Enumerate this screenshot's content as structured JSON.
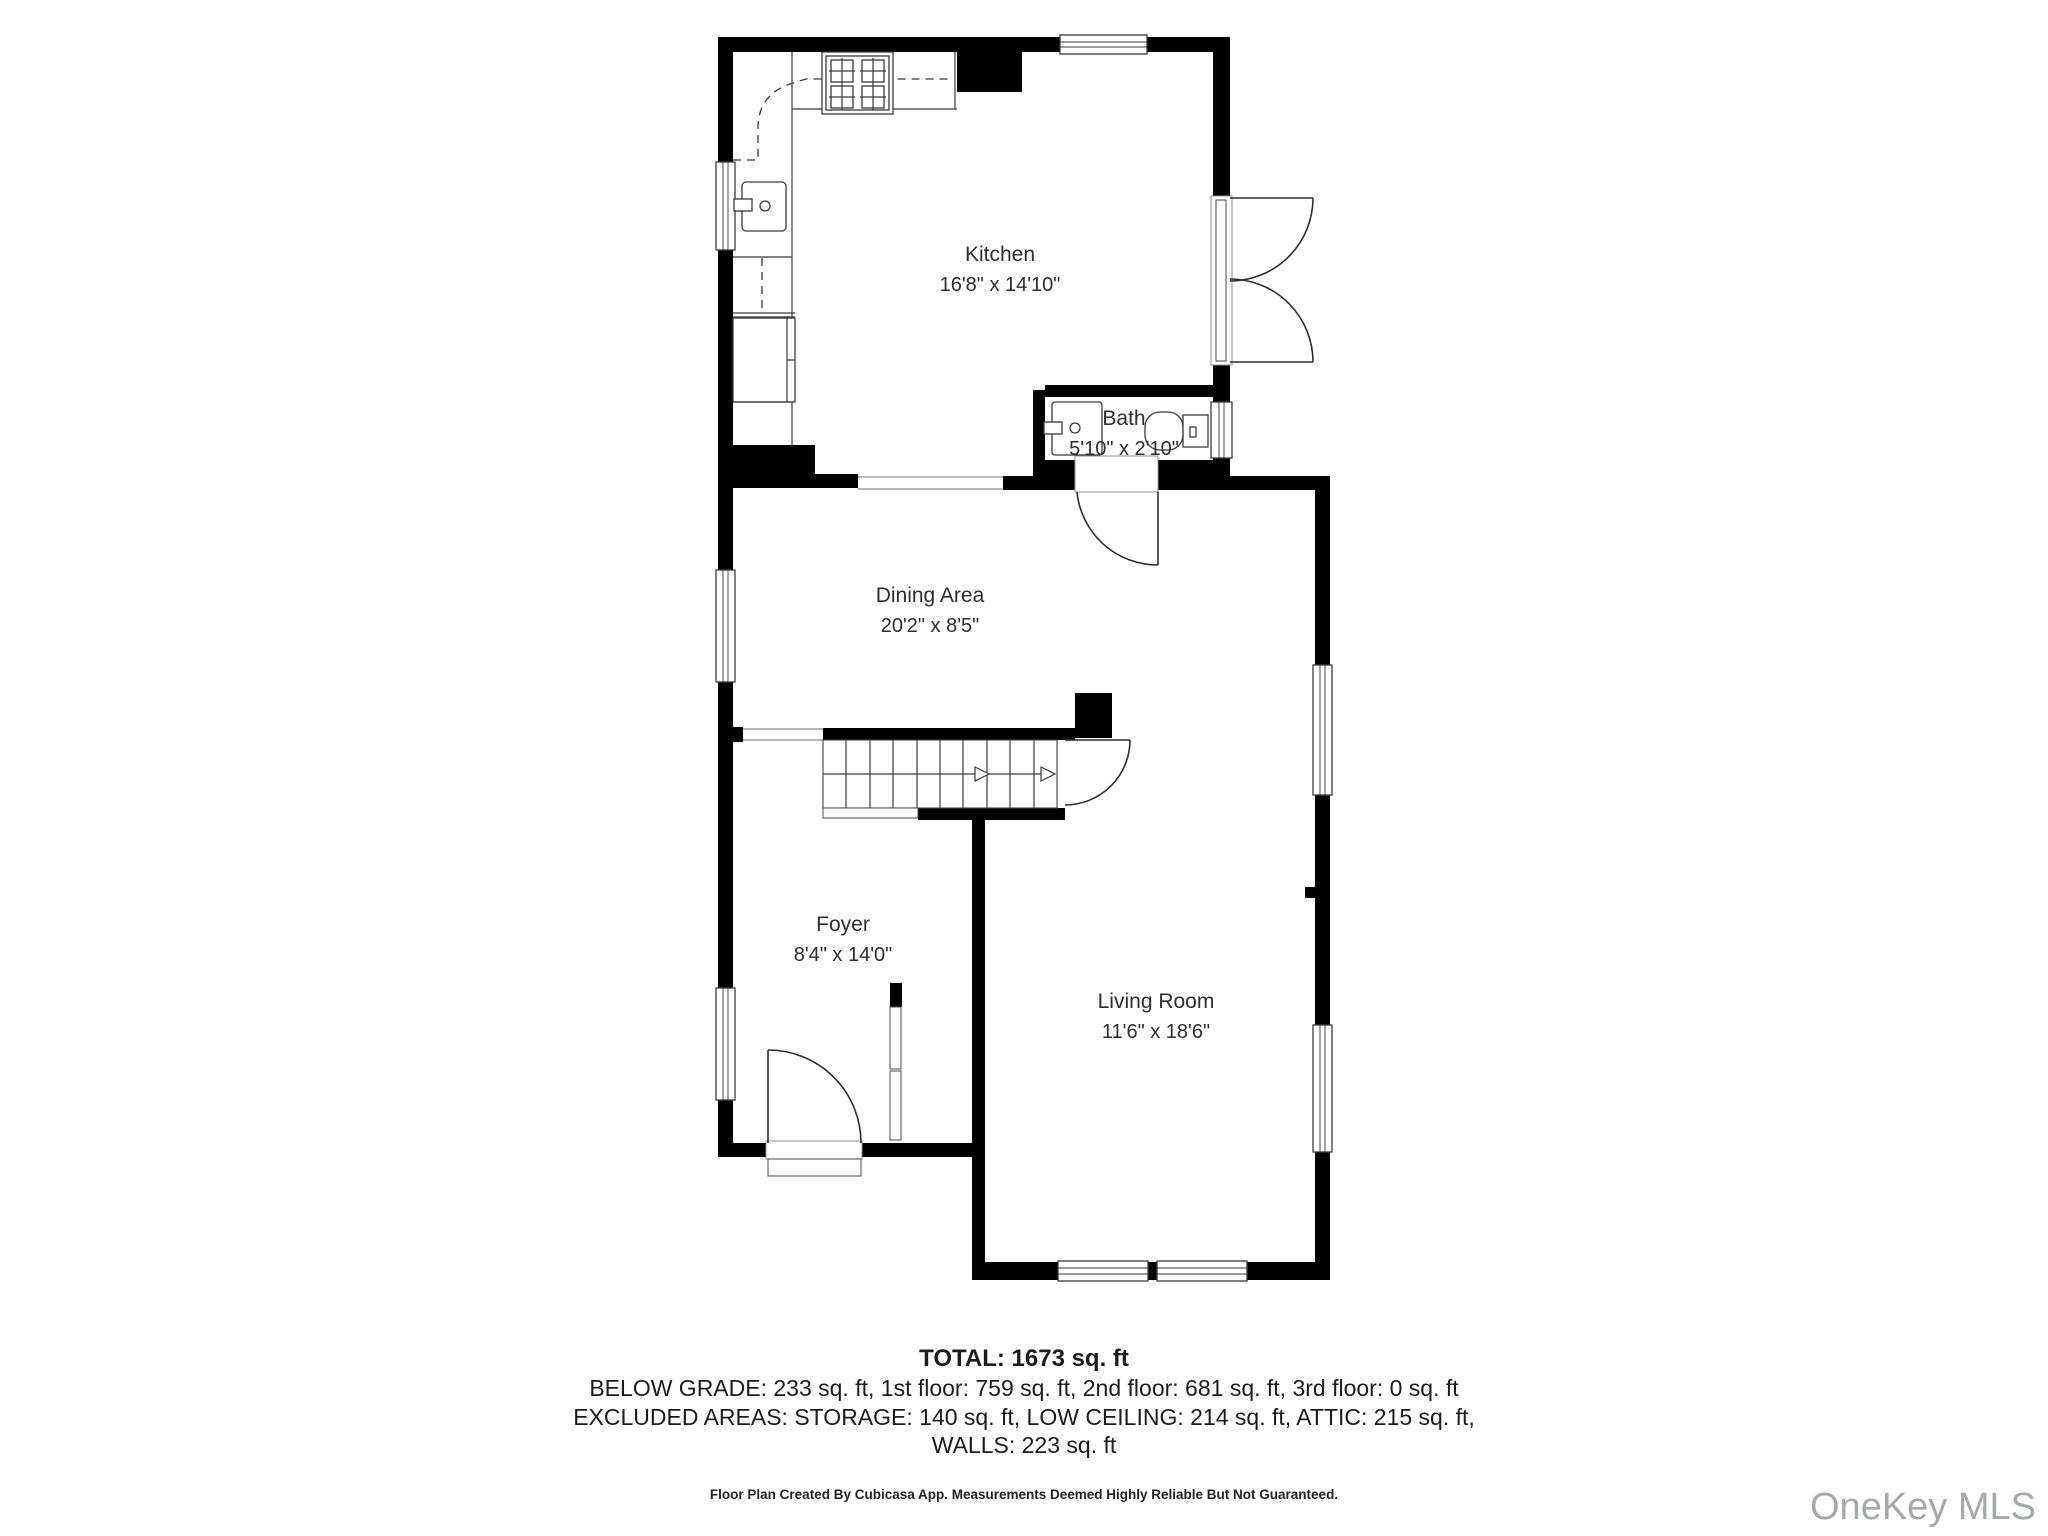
{
  "rooms": {
    "kitchen": {
      "name": "Kitchen",
      "dims": "16'8\" x 14'10\""
    },
    "bath": {
      "name": "Bath",
      "dims": "5'10\" x 2'10\""
    },
    "dining": {
      "name": "Dining Area",
      "dims": "20'2\" x 8'5\""
    },
    "foyer": {
      "name": "Foyer",
      "dims": "8'4\" x 14'0\""
    },
    "living": {
      "name": "Living Room",
      "dims": "11'6\" x 18'6\""
    }
  },
  "summary": {
    "total": "TOTAL: 1673 sq. ft",
    "below_grade_line": "BELOW GRADE: 233 sq. ft, 1st floor: 759 sq. ft, 2nd floor: 681 sq. ft, 3rd floor: 0 sq. ft",
    "excluded_line": "EXCLUDED AREAS: STORAGE: 140 sq. ft, LOW CEILING: 214 sq. ft, ATTIC: 215 sq. ft,",
    "walls_line": "WALLS: 223 sq. ft"
  },
  "footer": {
    "disclaimer": "Floor Plan Created By Cubicasa App. Measurements Deemed Highly Reliable But Not Guaranteed."
  },
  "watermark": {
    "text": "OneKey MLS",
    "color": "#a6a8aa"
  },
  "colors": {
    "wall": "#000000",
    "fixture_line": "#3a3a3a",
    "label_text": "#2e2e2e",
    "open_boundary": "#8f8f8f"
  }
}
